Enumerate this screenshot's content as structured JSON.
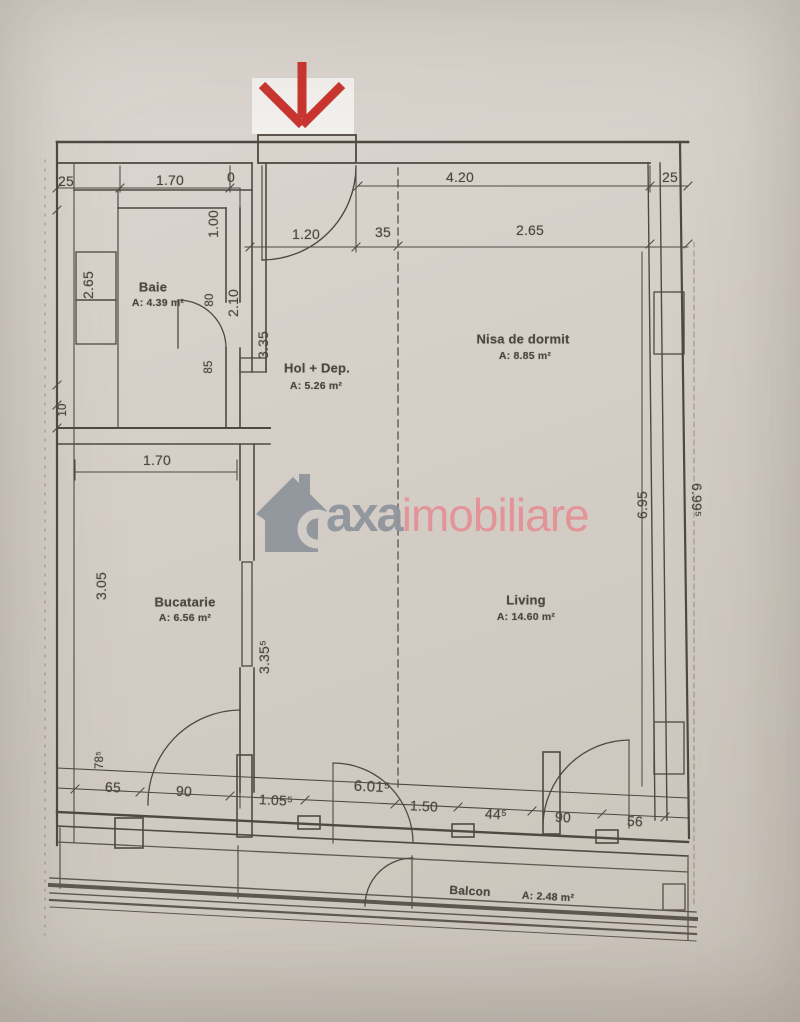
{
  "watermark": {
    "brand_primary": "axa",
    "brand_secondary": "imobiliare",
    "primary_color": "#8f949d",
    "secondary_color": "#ee8f96"
  },
  "entrance_arrow": {
    "direction": "down",
    "color": "#d63129"
  },
  "rooms": {
    "baie": {
      "name": "Baie",
      "area": "A: 4.39 m²"
    },
    "hol": {
      "name": "Hol + Dep.",
      "area": "A: 5.26 m²"
    },
    "nisa": {
      "name": "Nisa de dormit",
      "area": "A: 8.85 m²"
    },
    "bucatarie": {
      "name": "Bucatarie",
      "area": "A: 6.56 m²"
    },
    "living": {
      "name": "Living",
      "area": "A: 14.60 m²"
    },
    "balcon": {
      "name": "Balcon",
      "area": "A: 2.48 m²"
    }
  },
  "dims": {
    "top_left_25": "25",
    "top_1_70": "1.70",
    "top_0": "0",
    "top_4_20": "4.20",
    "top_right_25": "25",
    "v_1_00": "1.00",
    "row2_1_20": "1.20",
    "row2_35": "35",
    "row2_2_65": "2.65",
    "baie_v_2_65": "2.65",
    "baie_v_80": "80",
    "baie_v_2_10": "2.10",
    "baie_v_85": "85",
    "hol_v_3_35": "3.35",
    "left_v_10": "10",
    "buc_1_70": "1.70",
    "buc_v_3_05": "3.05",
    "buc_v_3_35_5": "3.35⁵",
    "right_v_6_95": "6.95",
    "right_v_6_99_5": "6.99⁵",
    "bottom_v_78_5": "78⁵",
    "bottom_65": "65",
    "bottom_90_a": "90",
    "bottom_1_05_5": "1.05⁵",
    "bottom_6_01_5": "6.01⁵",
    "bottom_1_50": "1.50",
    "bottom_44_5": "44⁵",
    "bottom_90_b": "90",
    "bottom_56": "56"
  }
}
